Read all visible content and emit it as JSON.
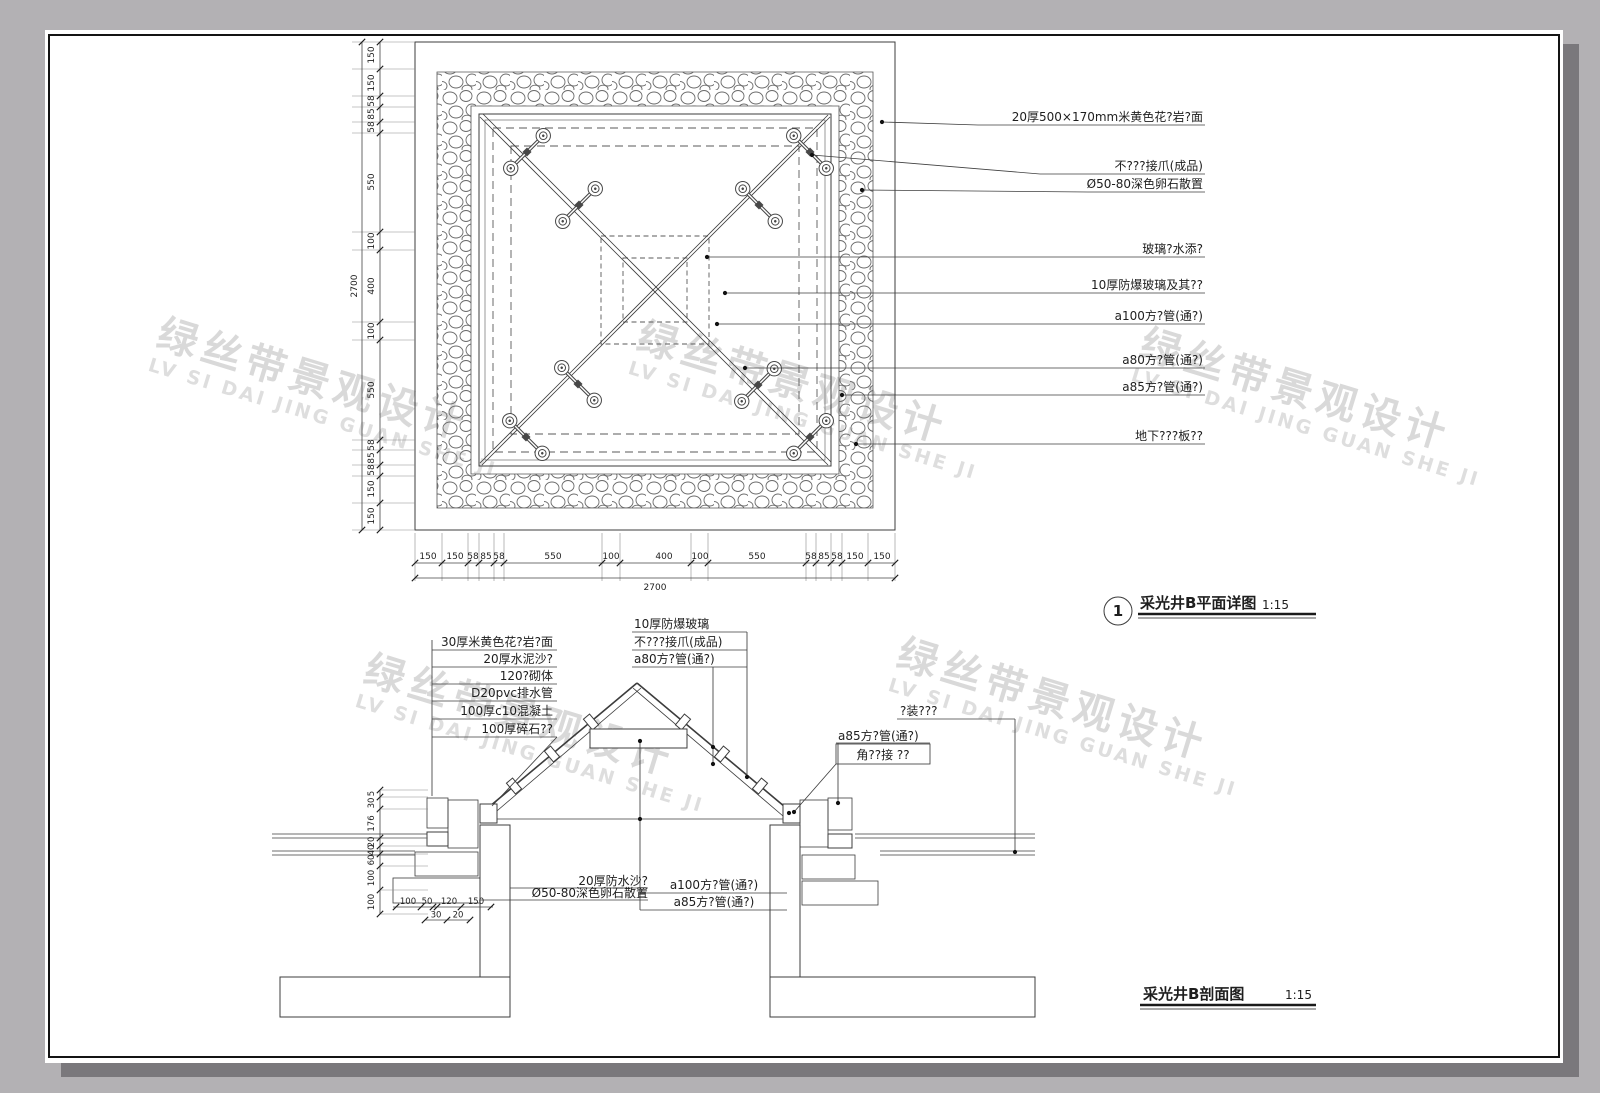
{
  "colors": {
    "page_bg": "#b3b1b4",
    "sheet": "#ffffff",
    "line": "#3c3c3c",
    "watermark": "#d9d9d9"
  },
  "watermark": {
    "cn": "绿丝带景观设计",
    "en": "LV SI DAI JING GUAN SHE JI"
  },
  "plan": {
    "callout_no": "1",
    "title": "采光井B平面详图",
    "scale": "1:15",
    "annotations": [
      "20厚500×170mm米黄色花?岩?面",
      "不???接爪(成品)",
      "Ø50-80深色卵石散置",
      "玻璃?水添?",
      "10厚防爆玻璃及其??",
      "a100方?管(通?)",
      "a80方?管(通?)",
      "a85方?管(通?)",
      "地下???板??"
    ],
    "dims_v": [
      "150",
      "150",
      "58",
      "85",
      "58",
      "550",
      "100",
      "400",
      "100",
      "550",
      "58",
      "85",
      "58",
      "150",
      "150"
    ],
    "dims_h": [
      "150",
      "150",
      "58",
      "85",
      "58",
      "550",
      "100",
      "400",
      "100",
      "550",
      "58",
      "85",
      "58",
      "150",
      "150"
    ],
    "overall_v": "2700",
    "overall_h": "2700"
  },
  "section": {
    "title": "采光井B剖面图",
    "scale": "1:15",
    "left_labels": [
      "30厚米黄色花?岩?面",
      "20厚水泥沙?",
      "120?砌体",
      "D20pvc排水管",
      "100厚c10混凝土",
      "100厚碎石??"
    ],
    "top_labels": [
      "10厚防爆玻璃",
      "不???接爪(成品)",
      "a80方?管(通?)"
    ],
    "right_top_label": "?装???",
    "right_pipe_label": "a85方?管(通?)",
    "right_corner_label": "角??接 ??",
    "pipe_labels": [
      "a100方?管(通?)",
      "a85方?管(通?)"
    ],
    "bottom_labels": [
      "20厚防水沙?",
      "Ø50-80深色卵石散置"
    ],
    "dims_left": [
      "5",
      "30",
      "176",
      "20",
      "40",
      "60",
      "100",
      "100"
    ],
    "dims_bottom_row1": [
      "100",
      "50",
      "120",
      "150"
    ],
    "dims_bottom_row2": [
      "30",
      "20"
    ]
  }
}
